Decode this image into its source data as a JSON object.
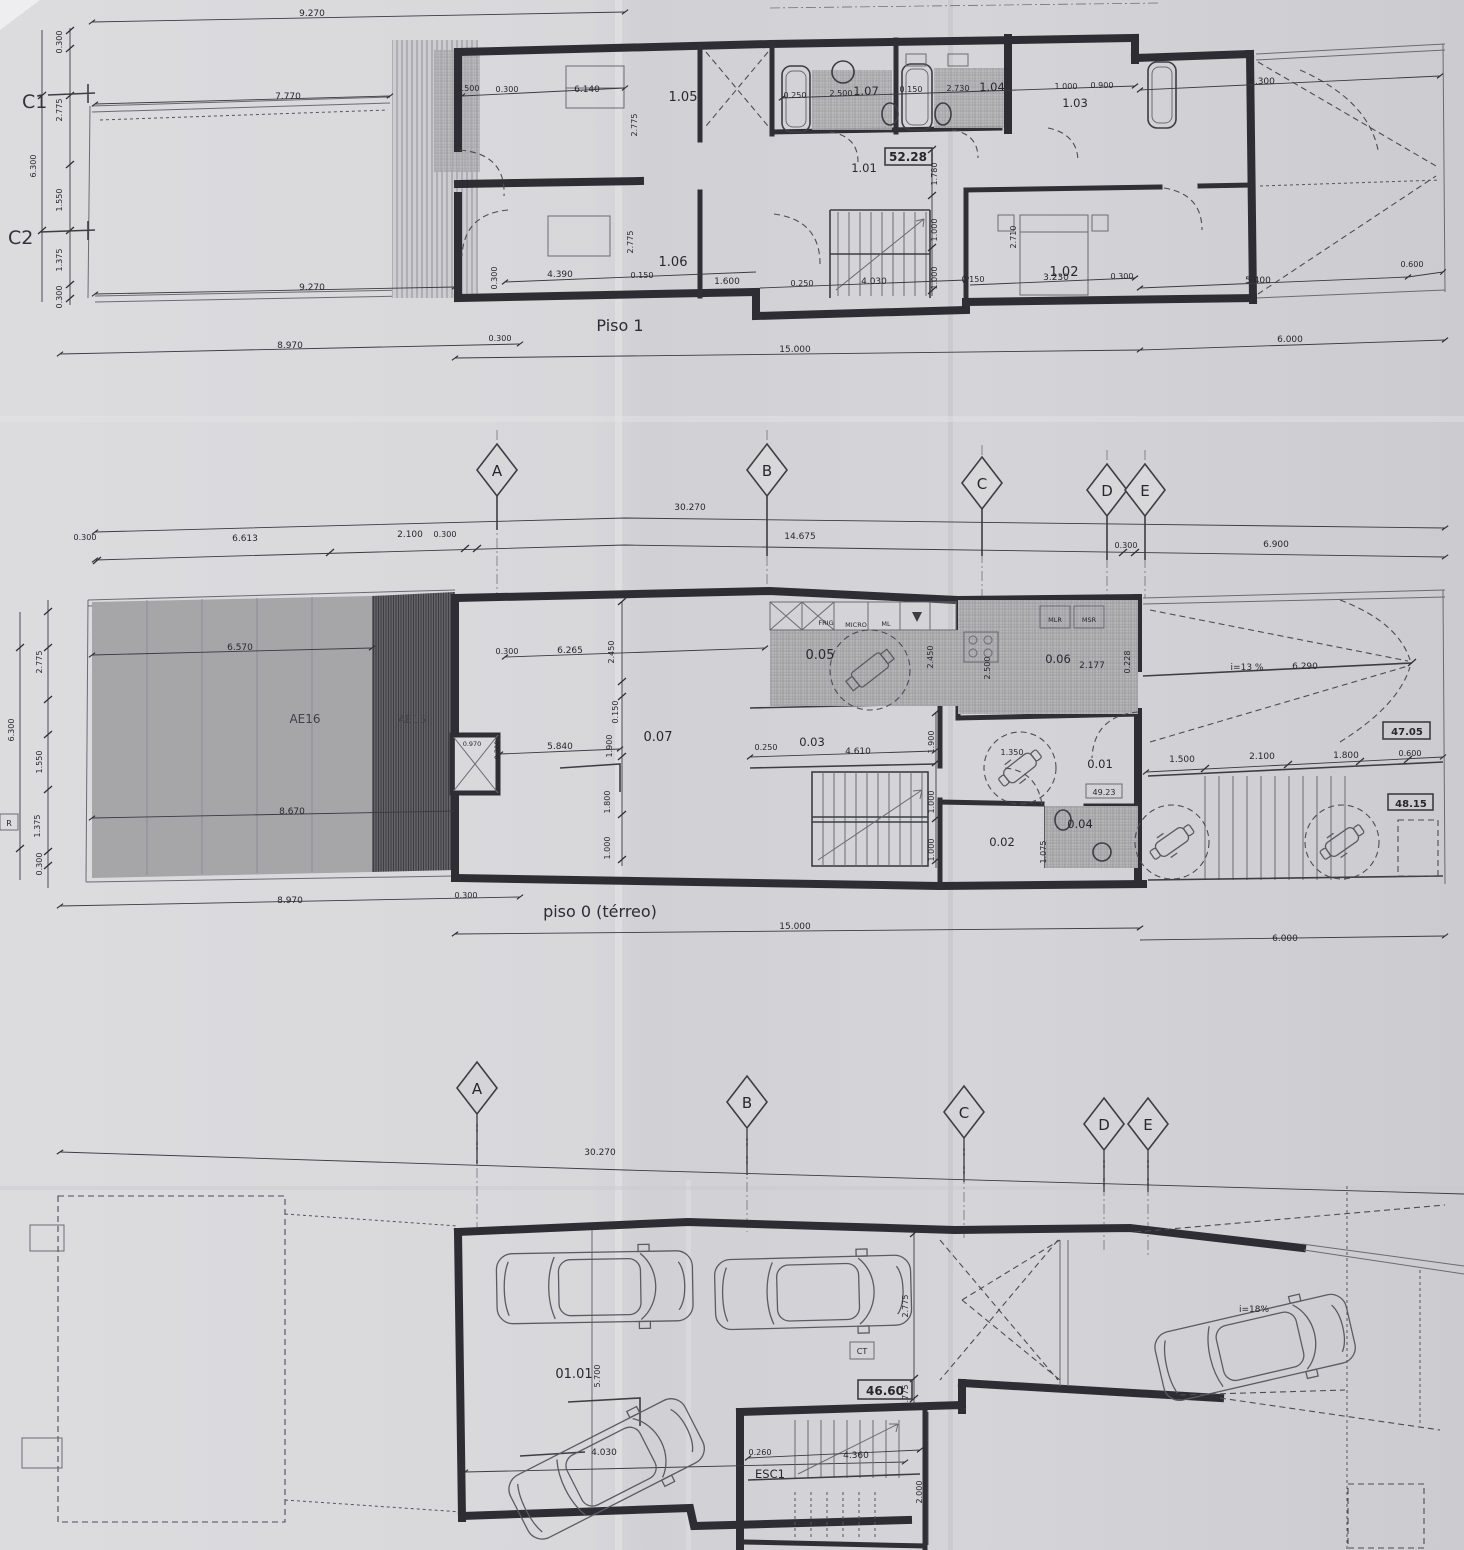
{
  "floor1": {
    "title": "Piso 1",
    "grid_c1": "C1",
    "grid_c2": "C2",
    "area_box": "52.28",
    "rooms": {
      "r101": "1.01",
      "r102": "1.02",
      "r103": "1.03",
      "r104": "1.04",
      "r105": "1.05",
      "r106": "1.06",
      "r107": "1.07"
    },
    "dims": {
      "top_9270": "9.270",
      "top_7770": "7.770",
      "mid_9270": "9.270",
      "right_6300": "6.300",
      "v_0300t": "0.300",
      "v_2775": "2.775",
      "v_6300": "6.300",
      "v_1550": "1.550",
      "v_1375": "1.375",
      "v_0300b": "0.300",
      "r_1500": "1.500",
      "r_0300": "0.300",
      "r_6140": "6.140",
      "v_2775a": "2.775",
      "v_2775b": "2.775",
      "b_0300l": "0.300",
      "b_4390": "4.390",
      "b_0150": "0.150",
      "b_1600": "1.600",
      "b_0250": "0.250",
      "b_4030": "4.030",
      "b_0150b": "0.150",
      "b_3230": "3.230",
      "b_0300": "0.300",
      "t_0250": "0.250",
      "t_2500": "2.500",
      "t_0150": "0.150",
      "t_2730": "2.730",
      "t_1000": "1.000",
      "t_0900": "0.900",
      "v_1780": "1.780",
      "v_1000a": "1.000",
      "v_1000b": "1.000",
      "v_2710": "2.710",
      "r_5400": "5.400",
      "r_0600": "0.600",
      "bot_8970": "8.970",
      "bot_0300": "0.300",
      "bot_15000": "15.000",
      "bot_6000": "6.000"
    }
  },
  "grid_row1": {
    "a": "A",
    "b": "B",
    "c": "C",
    "d": "D",
    "e": "E",
    "d_30270": "30.270",
    "d_0300l": "0.300",
    "d_6613": "6.613",
    "d_2100": "2.100",
    "d_0300m": "0.300",
    "d_14675": "14.675",
    "d_0300r": "0.300",
    "d_6900": "6.900"
  },
  "floor0": {
    "title": "piso 0 (térreo)",
    "ref_r": "R",
    "rooms": {
      "r001": "0.01",
      "r002": "0.02",
      "r003": "0.03",
      "r004": "0.04",
      "r005": "0.05",
      "r006": "0.06",
      "r007": "0.07"
    },
    "zones": {
      "ae16": "AE16",
      "ae15": "AE15"
    },
    "areas": {
      "a1": "47.05",
      "a2": "48.15",
      "a3": "49.23"
    },
    "appliances": {
      "frig": "FRIG",
      "micro": "MICRO",
      "ml": "ML",
      "mlr": "MLR",
      "msr": "MSR"
    },
    "ramp_slope": "i=13 %",
    "ramp_len": "6.290",
    "dims": {
      "v_2775": "2.775",
      "v_6300": "6.300",
      "v_1550": "1.550",
      "v_1375": "1.375",
      "v_0300": "0.300",
      "g_6570": "6.570",
      "g_8670": "8.670",
      "i_0300": "0.300",
      "i_6265": "6.265",
      "i_2450": "2.450",
      "i_0150": "0.150",
      "i_1900": "1.900",
      "i_5840": "5.840",
      "i_1800": "1.800",
      "i_1000a": "1.000",
      "s_0970": "0.970",
      "s_0300": "0.300",
      "k_2500": "2.500",
      "k_2450": "2.450",
      "k_2177": "2.177",
      "k_0228": "0.228",
      "c_0250": "0.250",
      "c_4610": "4.610",
      "c_1900": "1.900",
      "c_1000a": "1.000",
      "c_1000b": "1.000",
      "h_1350": "1.350",
      "h_1075": "1.075",
      "r_1500": "1.500",
      "r_2100": "2.100",
      "r_1800": "1.800",
      "r_0600": "0.600",
      "bot_8970": "8.970",
      "bot_0300": "0.300",
      "bot_15000": "15.000",
      "bot_6000": "6.000"
    }
  },
  "grid_row2": {
    "a": "A",
    "b": "B",
    "c": "C",
    "d": "D",
    "e": "E",
    "d_30270": "30.270"
  },
  "basement": {
    "room": "01.01",
    "area_box": "46.60",
    "stair": "ESC1",
    "ramp_slope": "i=18%",
    "ct": "CT",
    "dims": {
      "v_5700": "5.700",
      "b_4030": "4.030",
      "v_2775": "2.775",
      "v_0775": "0.775",
      "s_0260": "0.260",
      "s_4360": "4.360",
      "v_2000": "2.000"
    }
  }
}
